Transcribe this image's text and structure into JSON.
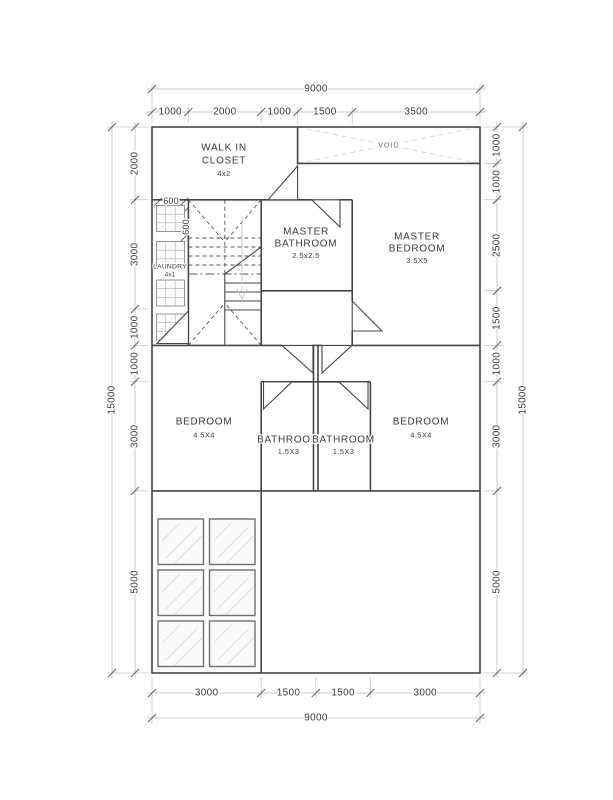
{
  "rooms": {
    "walk_in_closet": {
      "line1": "WALK IN",
      "line2": "CLOSET",
      "size": "4x2"
    },
    "void": {
      "label": "VOID"
    },
    "master_bathroom": {
      "line1": "MASTER",
      "line2": "BATHROOM",
      "size": "2.5x2.5"
    },
    "master_bedroom": {
      "line1": "MASTER",
      "line2": "BEDROOM",
      "size": "3.5X5"
    },
    "laundry": {
      "label": "LAUNDRY",
      "size": "4x1"
    },
    "bedroom_left": {
      "label": "BEDROOM",
      "size": "4.5X4"
    },
    "bathroom_left": {
      "label": "BATHROOM",
      "size": "1.5X3"
    },
    "bathroom_right": {
      "label": "BATHROOM",
      "size": "1.5X3"
    },
    "bedroom_right": {
      "label": "BEDROOM",
      "size": "4.5X4"
    }
  },
  "dimensions": {
    "top": {
      "total": "9000",
      "segments": [
        "1000",
        "2000",
        "1000",
        "1500",
        "3500"
      ]
    },
    "bottom": {
      "total": "9000",
      "segments": [
        "3000",
        "1500",
        "1500",
        "3000"
      ]
    },
    "left": {
      "total": "15000",
      "segments": [
        "2000",
        "3000",
        "1000",
        "1000",
        "3000",
        "5000"
      ]
    },
    "right": {
      "total": "15000",
      "segments": [
        "1000",
        "1000",
        "2500",
        "1500",
        "1000",
        "3000",
        "5000"
      ]
    },
    "stair_window": {
      "width": "600",
      "height": "600"
    }
  },
  "colors": {
    "wall": "#454545",
    "dimension_line": "#bdbdbd",
    "tick": "#6a6a6a",
    "text": "#3a3a3a",
    "void_hatch": "#d4d4d4",
    "background": "#ffffff"
  }
}
